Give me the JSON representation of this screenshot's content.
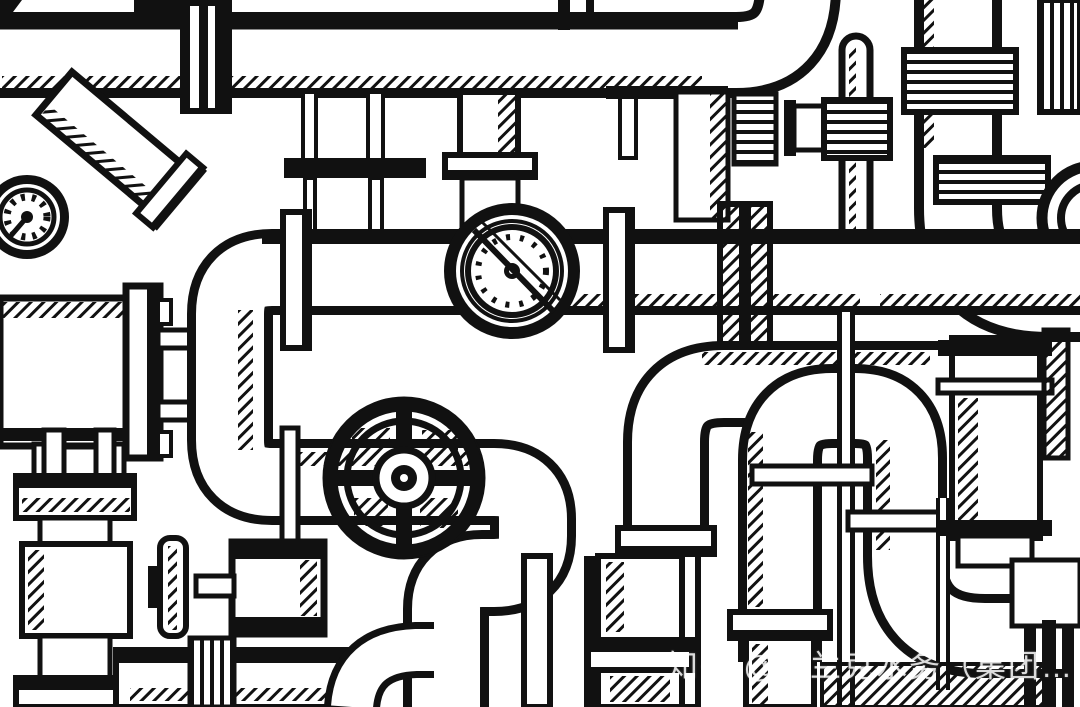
{
  "artwork": {
    "description": "Hand-drawn black ink sketch pattern of industrial plumbing: pipes, elbows, flanged joints, valves and round gauges on a white background",
    "style": "doodle / engraving line art",
    "palette": {
      "ink": "#111111",
      "paper": "#ffffff"
    },
    "elements": [
      "horizontal-pipe-top",
      "diagonal-branch-pipe",
      "small-pressure-gauge",
      "large-round-flow-meter",
      "c-shaped-pipe-bend",
      "spoked-handwheel-valve",
      "lever-valve",
      "tee-handle-valve",
      "u-bend-pipe-right",
      "flange-joints",
      "bottom-pipe-columns",
      "partial-handwheel-right-edge"
    ]
  },
  "watermark": {
    "text": "知乎 @富兰克水务（集团…",
    "color": "#ffffff",
    "opacity": 0.82,
    "position": "bottom-right"
  }
}
